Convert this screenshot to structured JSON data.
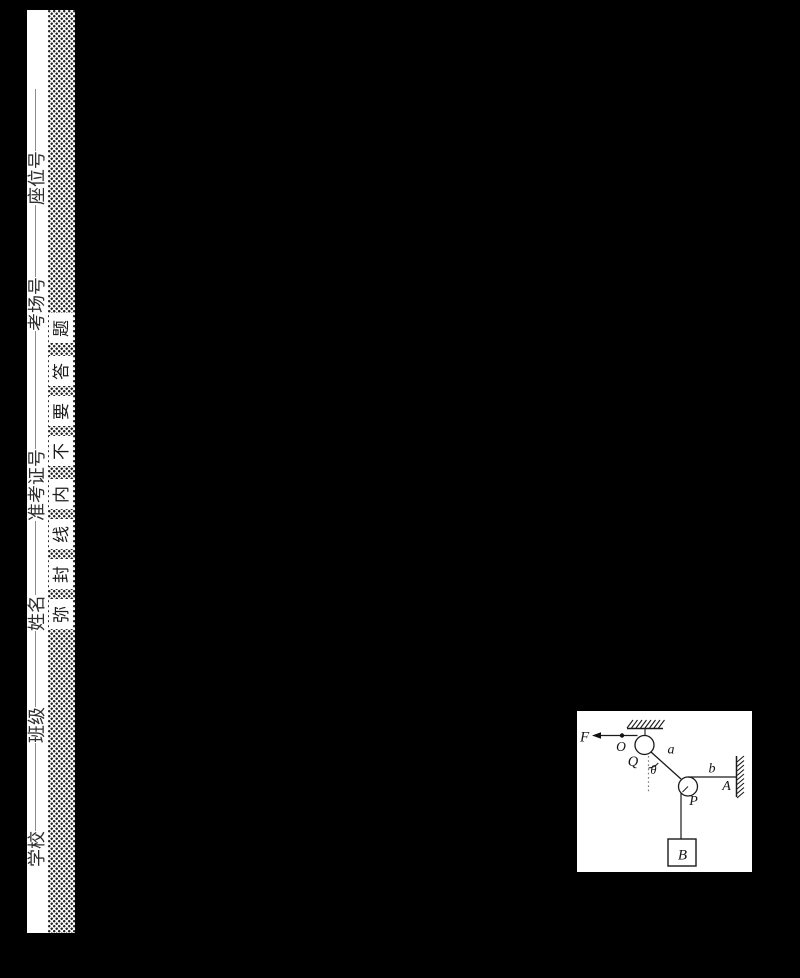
{
  "seal": {
    "fields": [
      {
        "label": "学校"
      },
      {
        "label": "班级"
      },
      {
        "label": "姓名"
      },
      {
        "label": "准考证号"
      },
      {
        "label": "考场号"
      },
      {
        "label": "座位号"
      }
    ],
    "phrase_reading_bottom_to_top": "弥封线内不要答题",
    "chars_top_to_bottom": [
      "题",
      "答",
      "要",
      "不",
      "内",
      "线",
      "封",
      "弥"
    ]
  },
  "diagram": {
    "labels": {
      "force": "F",
      "point_o": "O",
      "pulley_q": "Q",
      "angle": "θ",
      "rope_a": "a",
      "rope_b": "b",
      "wall_a": "A",
      "pulley_p": "P",
      "block_b": "B"
    }
  }
}
